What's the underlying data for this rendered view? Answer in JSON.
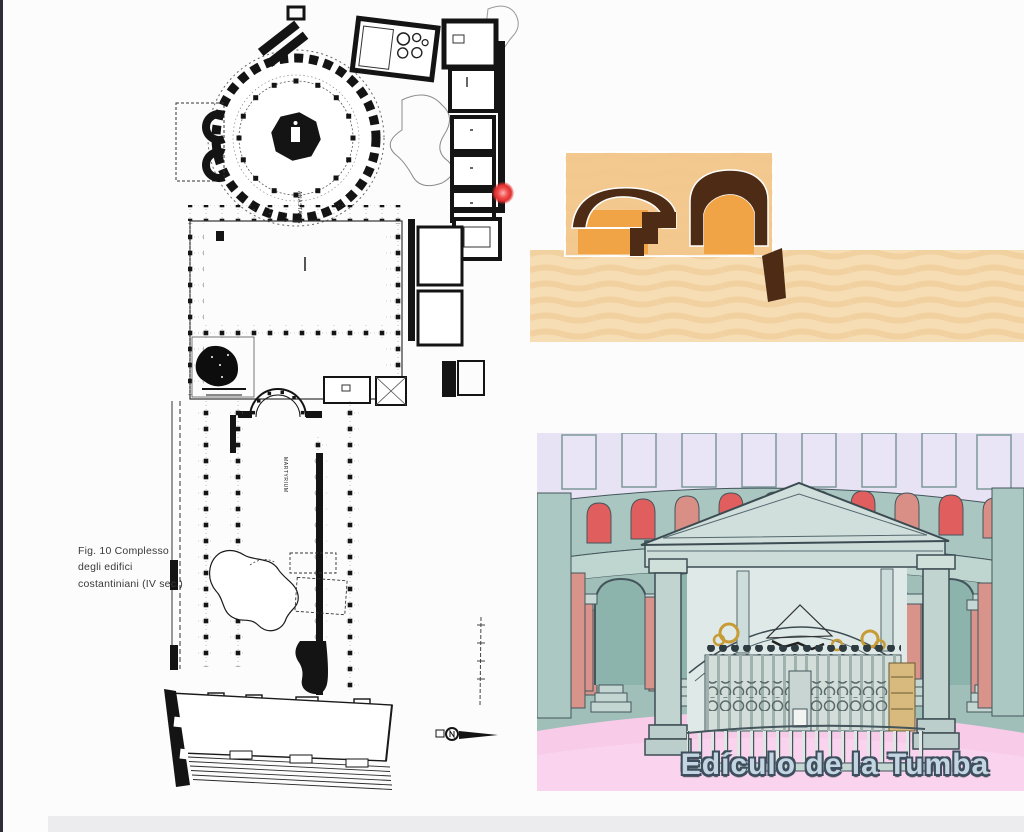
{
  "plan": {
    "caption": {
      "line1": "Fig. 10  Complesso",
      "line2": "degli edifici",
      "line3": "costantiniani (IV sec.)"
    },
    "labels": {
      "rotunda": "ANASTASIS",
      "basilica": "MARTYRIUM"
    },
    "ink_color": "#1a1a1a"
  },
  "tomb_section_figure": {
    "panel_color": "#f3c98f",
    "arch_core_color": "#f0a446",
    "rock_color": "#4e2b14",
    "ground_color": "#f6ddb4"
  },
  "rotunda_figure": {
    "caption": "Edículo de la Tumba",
    "caption_fill": "#c3d5e0",
    "caption_outline": "#3e4e5e",
    "wall_color": "#a9c7c0",
    "arch_red": "#e15e5e",
    "arch_salmon": "#d98f85",
    "column_salmon": "#d8948a",
    "floor_pink": "#f8cbe9",
    "window_lavender": "#e7e3f4",
    "aedicule_color": "#ccdcd8",
    "gold_color": "#c79b35",
    "door_tan": "#d9ba7e"
  },
  "pointer": {
    "color": "#e22e2e"
  }
}
